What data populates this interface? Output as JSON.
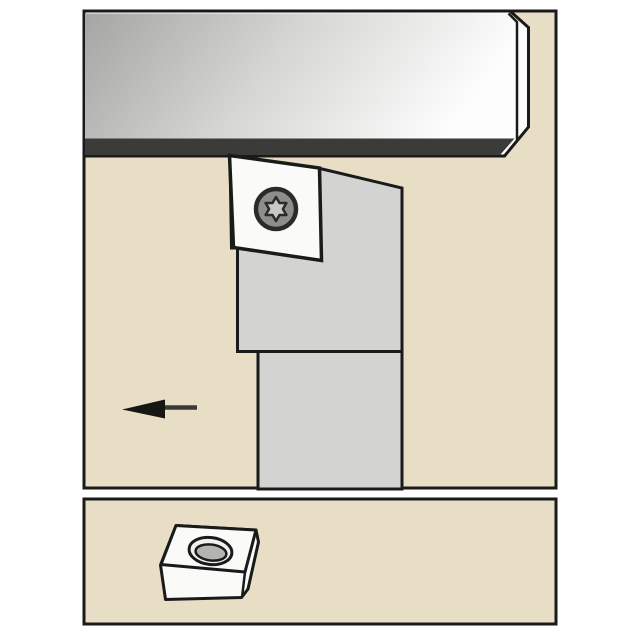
{
  "page": {
    "background": "#ffffff",
    "description": "Catalog line-art illustration of an external lathe toolholder with screw-clamped diamond insert cutting a workpiece, plus a separate lower panel showing the matching indexable insert"
  },
  "colors": {
    "panel_fill": "#e8dec5",
    "outline": "#1a1a1a",
    "workpiece_end_face": "#fcfcfc",
    "workpiece_dark": "#a5a5a3",
    "workpiece_mid": "#d6d6d4",
    "workpiece_light": "#fdfdfd",
    "workpiece_edge_band": "#3b3b39",
    "holder_gray": "#d3d3d1",
    "insert_white": "#fafaf8",
    "screw_ring": "#8e8e8c",
    "screw_star": "#c8c8c6",
    "screw_outline": "#2b2b29",
    "arrow_head": "#161614",
    "arrow_line": "#3a3a36",
    "hole_ring": "#f0f0ee",
    "hole_bore": "#b4b4b0"
  },
  "main_panel": {
    "name": "toolholder application view",
    "workpiece": "gray machined bar with dark cut edge band",
    "toolholder": "square-shank turning toolholder, head with clamped insert",
    "insert": "55-degree diamond insert, white, torx clamp screw",
    "feed_arrow": {
      "direction": "left"
    }
  },
  "insert_panel": {
    "name": "indexable insert view",
    "insert": "rhombic (diamond) turning insert with central countersunk hole, 3D view"
  }
}
